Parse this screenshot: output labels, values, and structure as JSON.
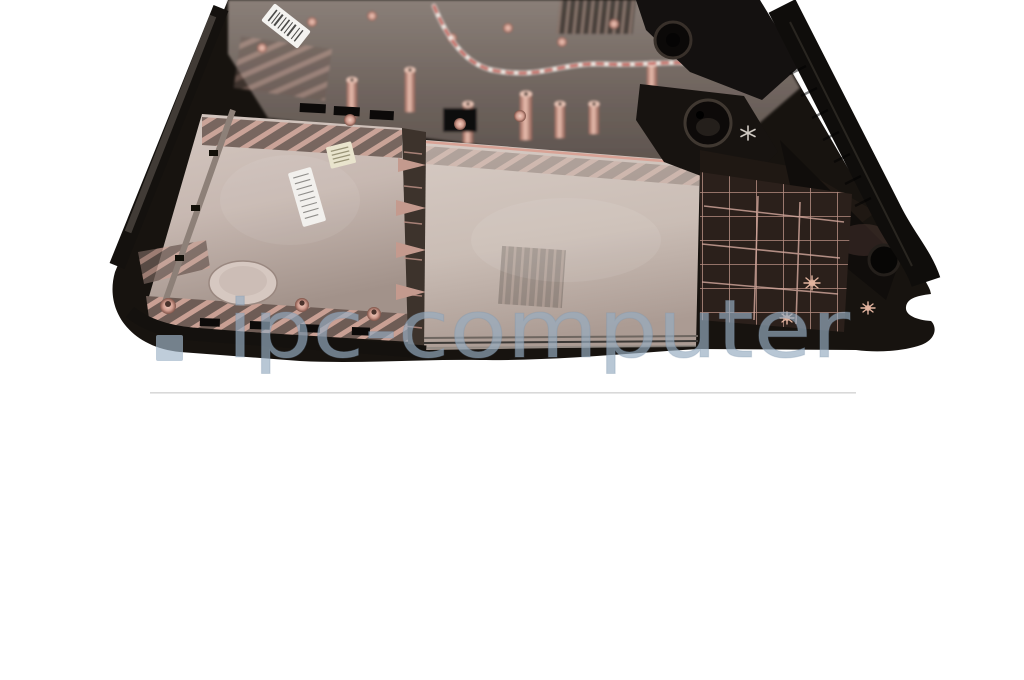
{
  "image": {
    "alt": "Laptop bottom case, interior view, dark plastic with copper-pink sheen on white studio background",
    "background_color": "#ffffff"
  },
  "watermark": {
    "text": "ipc-computer",
    "text_color": "#96acc1",
    "square_color": "#a0b5c8",
    "opacity": "0.68"
  },
  "divider": {
    "color": "#d9d9d9"
  },
  "palette": {
    "case_rim": "#17130f",
    "hinge_black": "#141110",
    "top_region": "#7b706a",
    "panel_left": "#c9bbb4",
    "panel_center": "#cec2bb",
    "copper": "#d8a498",
    "lattice_dark": "#2b201b",
    "label_white": "#f2f0ed",
    "label_yellow": "#e9e4cd",
    "barcode_white": "#f4f3f0",
    "wire_red": "#c0392b",
    "wire_white": "#f3efe9"
  }
}
